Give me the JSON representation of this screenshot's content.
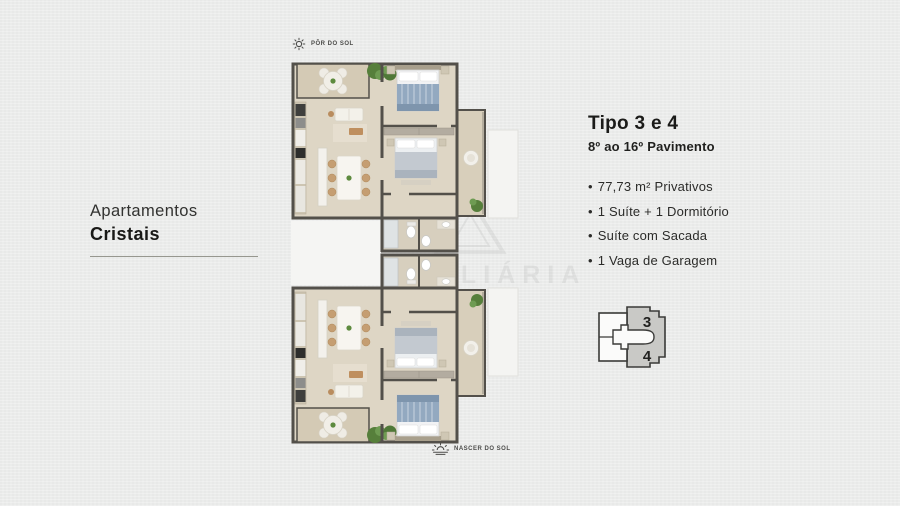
{
  "page": {
    "background_color": "#ebeceb",
    "heading_color": "#1b1b19"
  },
  "left_panel": {
    "title_line1": "Apartamentos",
    "title_line2": "Cristais"
  },
  "orientation": {
    "top": {
      "icon": "sunset-icon",
      "label": "PÔR DO SOL"
    },
    "bottom": {
      "icon": "sunrise-icon",
      "label": "NASCER DO SOL"
    }
  },
  "info_panel": {
    "title": "Tipo 3 e 4",
    "subtitle": "8º ao 16º Pavimento",
    "bullet": "•",
    "features": [
      "77,73 m² Privativos",
      "1 Suíte + 1 Dormitório",
      "Suíte com Sacada",
      "1 Vaga de Garagem"
    ]
  },
  "key_plan": {
    "unit_top": "3",
    "unit_bottom": "4",
    "highlight_color": "#c9c9c6",
    "outline_color": "#3a3a38"
  },
  "watermark": {
    "text": "IMOBILIÁRIA"
  },
  "floor_plans": {
    "count": 2,
    "arrangement": "two mirrored units stacked vertically",
    "colors": {
      "wall": "#53504a",
      "floor": "#ded6c5",
      "balcony_floor": "#d5cbb7",
      "bed_blue": "#93a9c0",
      "bed_gray": "#c3c9d0",
      "plant_green": "#567f3b",
      "wood": "#c59e72"
    }
  }
}
